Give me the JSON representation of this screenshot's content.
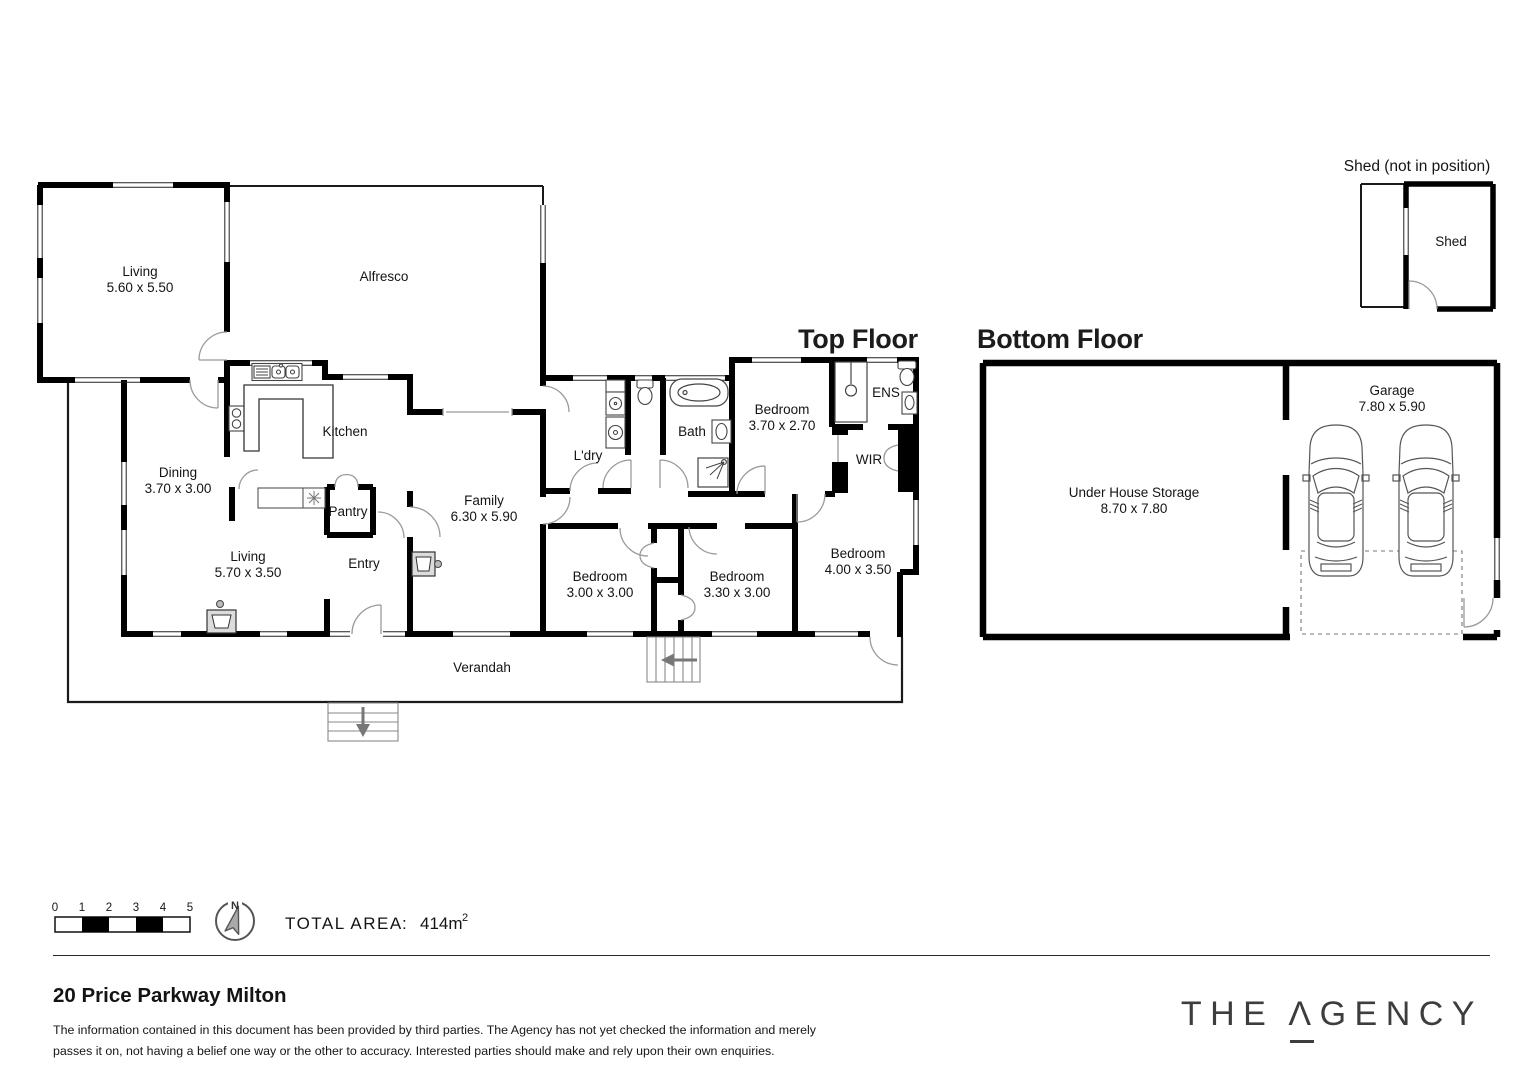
{
  "titles": {
    "top_floor": "Top Floor",
    "bottom_floor": "Bottom Floor",
    "shed": "Shed (not in position)"
  },
  "rooms": {
    "living1": {
      "name": "Living",
      "dims": "5.60 x 5.50"
    },
    "alfresco": {
      "name": "Alfresco"
    },
    "kitchen": {
      "name": "Kitchen"
    },
    "dining": {
      "name": "Dining",
      "dims": "3.70 x 3.00"
    },
    "pantry": {
      "name": "Pantry"
    },
    "living2": {
      "name": "Living",
      "dims": "5.70 x 3.50"
    },
    "entry": {
      "name": "Entry"
    },
    "family": {
      "name": "Family",
      "dims": "6.30 x 5.90"
    },
    "ldry": {
      "name": "L'dry"
    },
    "bath": {
      "name": "Bath"
    },
    "bed1": {
      "name": "Bedroom",
      "dims": "3.70 x 2.70"
    },
    "ens": {
      "name": "ENS"
    },
    "wir": {
      "name": "WIR"
    },
    "bed2": {
      "name": "Bedroom",
      "dims": "3.00 x 3.00"
    },
    "bed3": {
      "name": "Bedroom",
      "dims": "3.30 x 3.00"
    },
    "bed4": {
      "name": "Bedroom",
      "dims": "4.00 x 3.50"
    },
    "verandah": {
      "name": "Verandah"
    },
    "storage": {
      "name": "Under House Storage",
      "dims": "8.70 x 7.80"
    },
    "garage": {
      "name": "Garage",
      "dims": "7.80 x 5.90"
    },
    "shed": {
      "name": "Shed"
    }
  },
  "scale_bar": {
    "ticks": [
      "0",
      "1",
      "2",
      "3",
      "4",
      "5"
    ]
  },
  "compass": {
    "north_label": "N"
  },
  "total_area": {
    "label": "TOTAL AREA",
    "separator": ":",
    "value": "414m",
    "superscript": "2"
  },
  "footer": {
    "address": "20 Price Parkway Milton",
    "disclaimer_line1": "The information contained in this document has been provided by third parties. The Agency has not yet checked the information and merely",
    "disclaimer_line2": "passes it on, not having a belief one way or the other to accuracy. Interested parties should make and rely upon their own enquiries.",
    "logo": {
      "word1": "THE",
      "a_glyph": "Λ",
      "word2_rest": "GENCY"
    }
  },
  "colors": {
    "wall": "#000000",
    "text": "#141414",
    "door_arc": "#9a9a9a",
    "logo": "#3d3d3d"
  }
}
